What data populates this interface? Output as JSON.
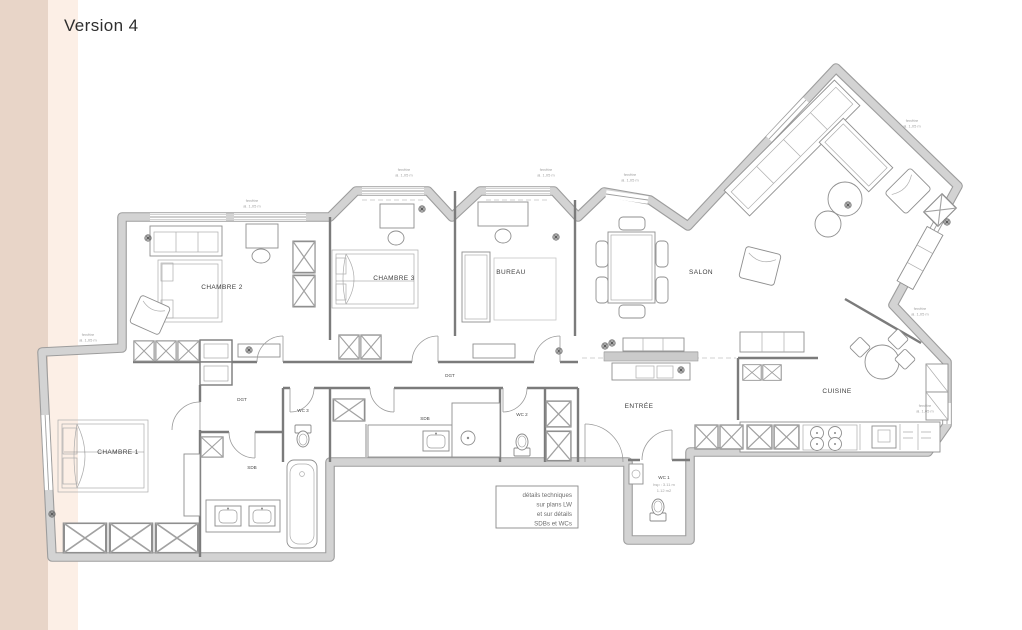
{
  "page": {
    "title": "Version 4"
  },
  "colors": {
    "sidebar_band_outer": "#e8d5c8",
    "sidebar_band_inner": "#fcefe6",
    "background": "#ffffff",
    "wall_fill": "#d3d3d3",
    "wall_edge": "#9d9d9d",
    "label_text": "#404040",
    "annotation_text": "#a3a3a3"
  },
  "plan": {
    "rooms": [
      {
        "id": "chambre2",
        "label": "CHAMBRE 2"
      },
      {
        "id": "chambre3",
        "label": "CHAMBRE 3"
      },
      {
        "id": "bureau",
        "label": "BUREAU"
      },
      {
        "id": "salon",
        "label": "SALON"
      },
      {
        "id": "entree",
        "label": "ENTRÉE"
      },
      {
        "id": "cuisine",
        "label": "CUISINE"
      },
      {
        "id": "chambre1",
        "label": "CHAMBRE 1"
      },
      {
        "id": "dgt-west",
        "label": "DGT"
      },
      {
        "id": "dgt-main",
        "label": "DGT"
      },
      {
        "id": "sdb-south",
        "label": "SDB"
      },
      {
        "id": "sdb-mid",
        "label": "SDB"
      },
      {
        "id": "wc1",
        "label": "WC 1"
      },
      {
        "id": "wc2",
        "label": "WC 2"
      },
      {
        "id": "wc3",
        "label": "WC 3"
      }
    ],
    "wc1_details": [
      "hsp : 3.11 m",
      "1.12 m2"
    ],
    "note_box": {
      "lines": [
        "détails techniques",
        "sur plans LW",
        "et sur détails",
        "SDBs et WCs"
      ]
    },
    "window_note": {
      "line1": "fenêtre",
      "line2": "al. 1,05 m"
    }
  }
}
